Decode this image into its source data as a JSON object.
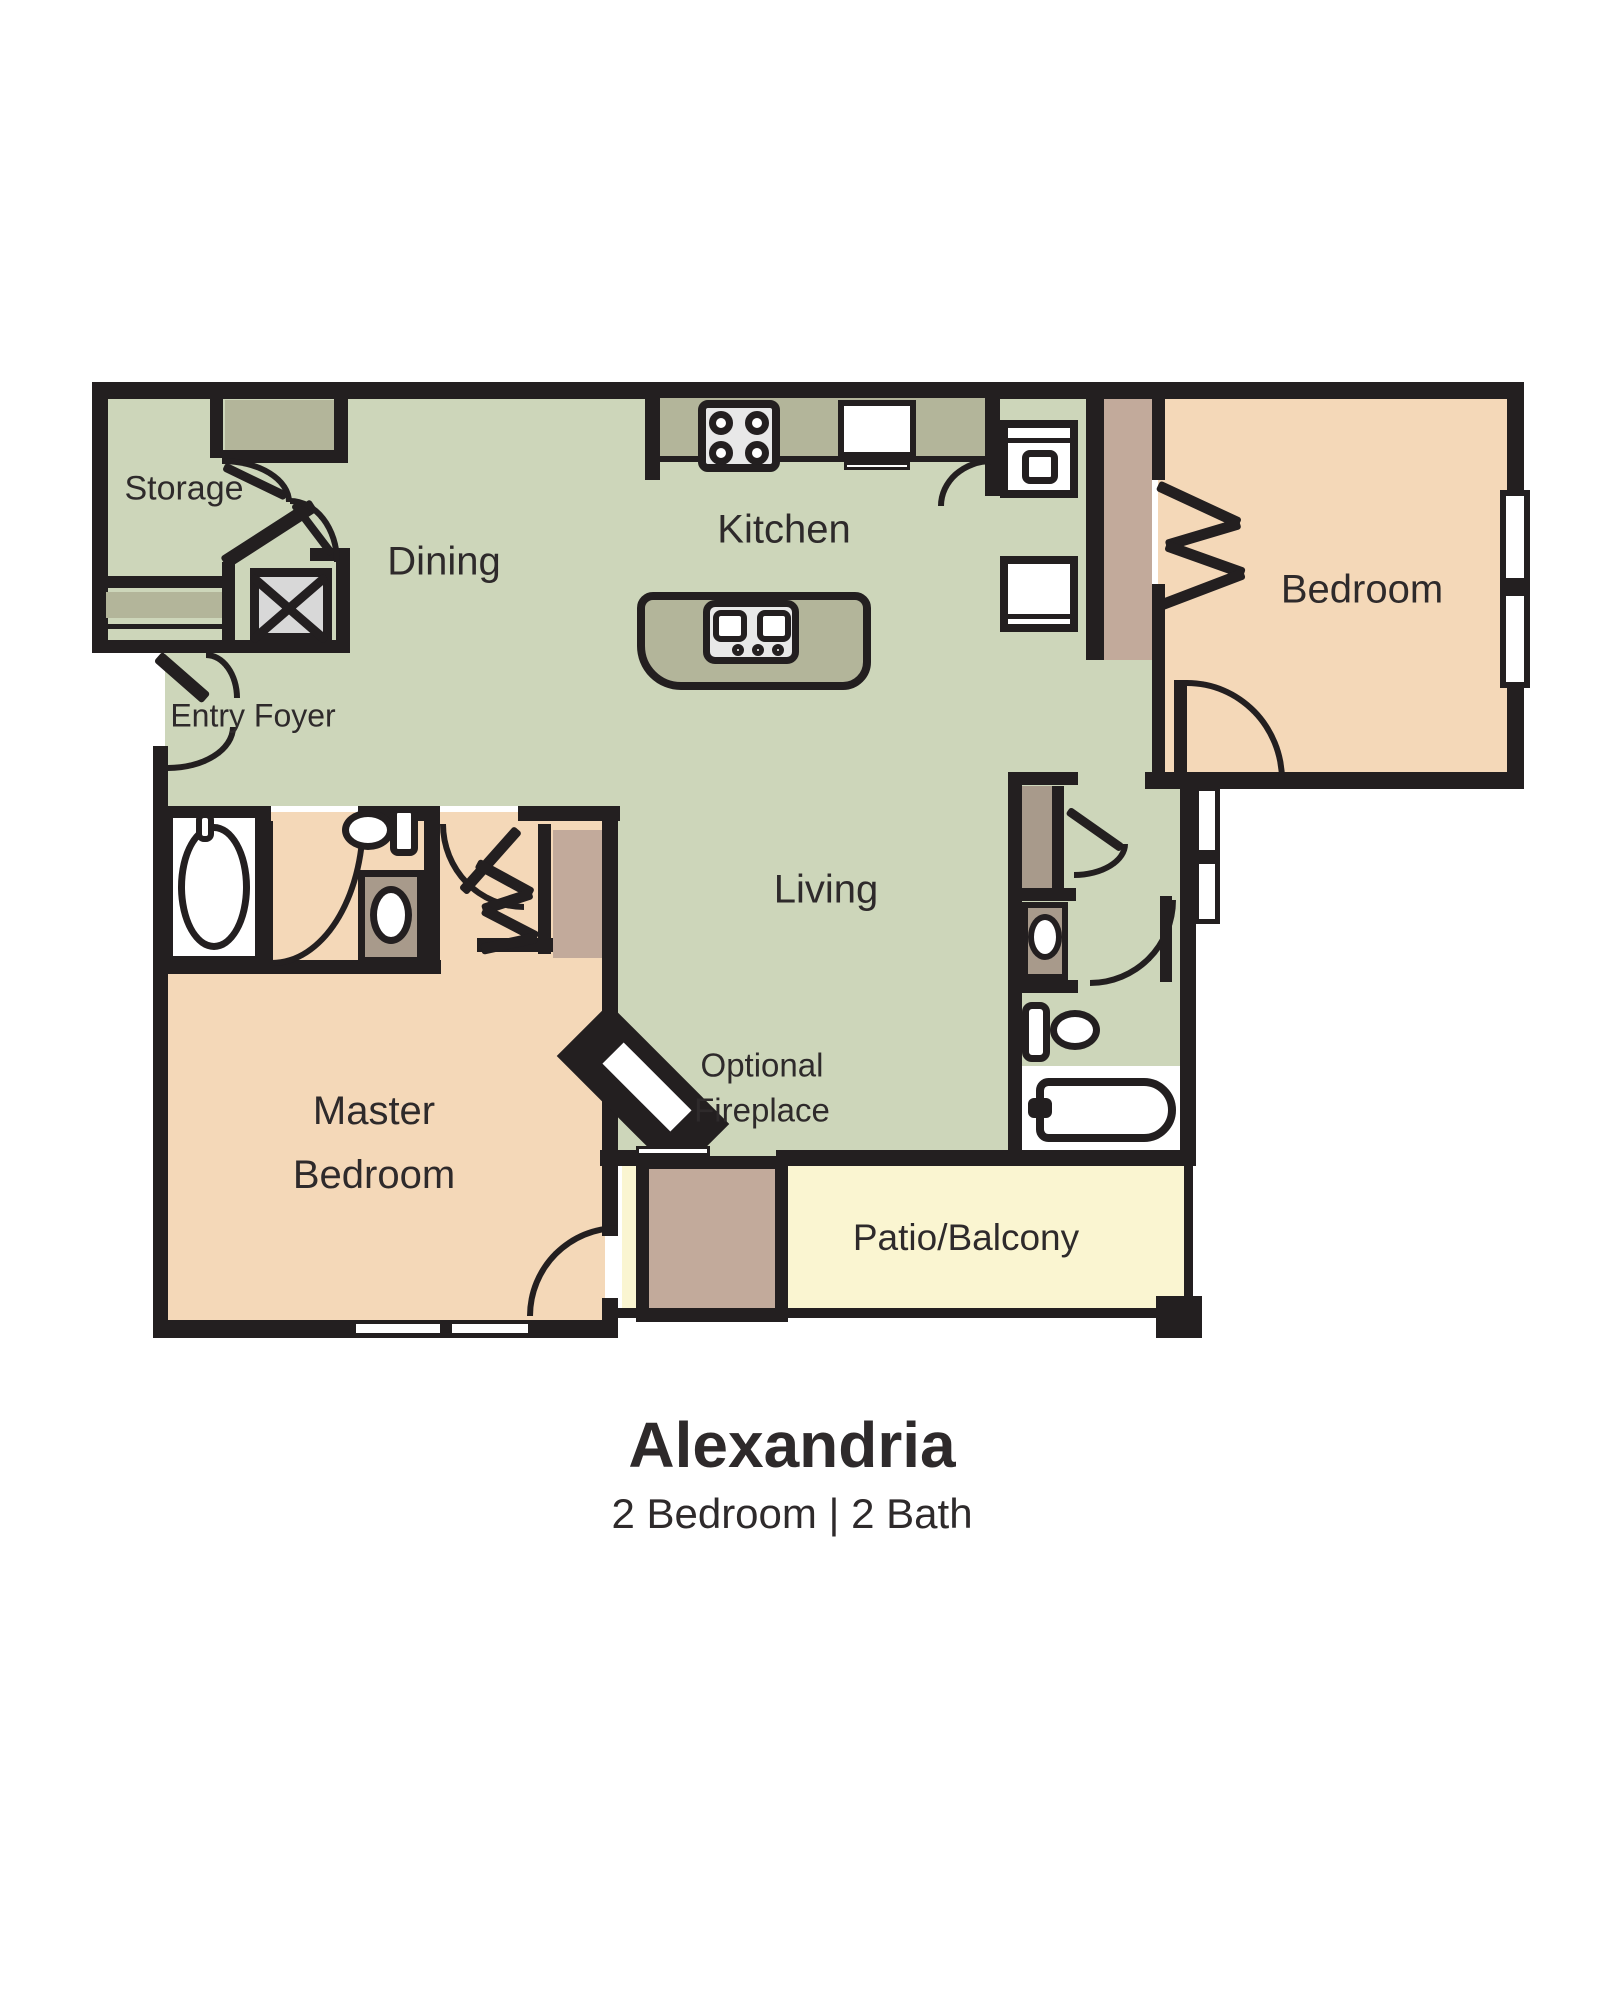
{
  "floor_plan": {
    "title": "Alexandria",
    "subtitle": "2 Bedroom | 2 Bath",
    "rooms": {
      "storage": "Storage",
      "dining": "Dining",
      "kitchen": "Kitchen",
      "bedroom": "Bedroom",
      "entry_foyer": "Entry Foyer",
      "living": "Living",
      "master_line1": "Master",
      "master_line2": "Bedroom",
      "fireplace_line1": "Optional",
      "fireplace_line2": "Fireplace",
      "patio": "Patio/Balcony"
    },
    "colors": {
      "wall": "#231f20",
      "room_green": "#cdd6ba",
      "counter": "#b3b59a",
      "room_peach": "#f4d8b8",
      "accent_tan": "#c2aa9b",
      "vanity_tan": "#a89a8b",
      "patio_yellow": "#faf5d1",
      "appliance_gray": "#d8d8d8",
      "text": "#2e2a2b"
    }
  }
}
